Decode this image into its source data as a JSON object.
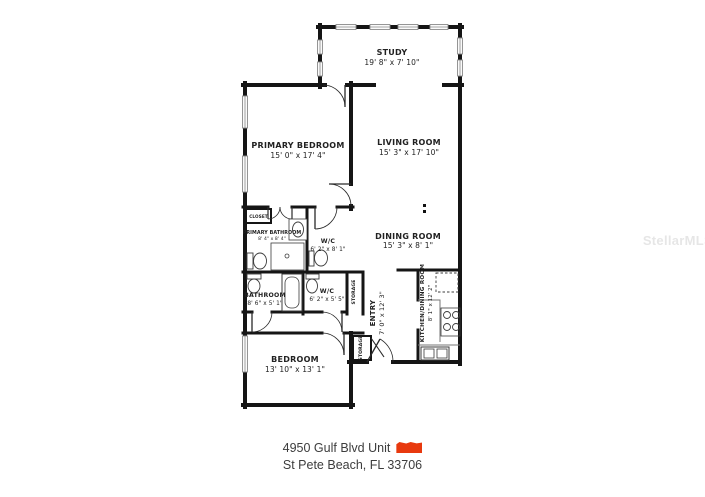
{
  "watermark": "StellarMLS",
  "address": {
    "line1": "4950 Gulf Blvd Unit",
    "line2": "St Pete Beach, FL 33706"
  },
  "redaction_color": "#e8390e",
  "rooms": {
    "study": {
      "name": "STUDY",
      "dims": "19' 8\" x 7' 10\""
    },
    "living_room": {
      "name": "LIVING ROOM",
      "dims": "15' 3\" x 17' 10\""
    },
    "primary_bedroom": {
      "name": "PRIMARY BEDROOM",
      "dims": "15' 0\" x 17' 4\""
    },
    "dining_room": {
      "name": "DINING ROOM",
      "dims": "15' 3\" x 8' 1\""
    },
    "bedroom": {
      "name": "BEDROOM",
      "dims": "13' 10\" x 13' 1\""
    },
    "bathroom": {
      "name": "BATHROOM",
      "dims": "8' 6\" x 5' 1\""
    },
    "wc_upper": {
      "name": "W/C",
      "dims": "6' 2\" x 8' 1\""
    },
    "wc_lower": {
      "name": "W/C",
      "dims": "6' 2\" x 5' 5\""
    },
    "primary_bathroom": {
      "name": "PRIMARY BATHROOM",
      "dims": "8' 4\" x 8' 4\""
    },
    "entry": {
      "name": "ENTRY",
      "dims": "7' 0\" x 12' 3\""
    },
    "kitchen": {
      "name": "KITCHEN/DINING ROOM",
      "dims": "8' 1\" x 12' 2\""
    },
    "closet": {
      "name": "CLOSET"
    },
    "storage_hall": {
      "name": "STORAGE"
    },
    "storage_entry": {
      "name": "STORAGE"
    }
  }
}
